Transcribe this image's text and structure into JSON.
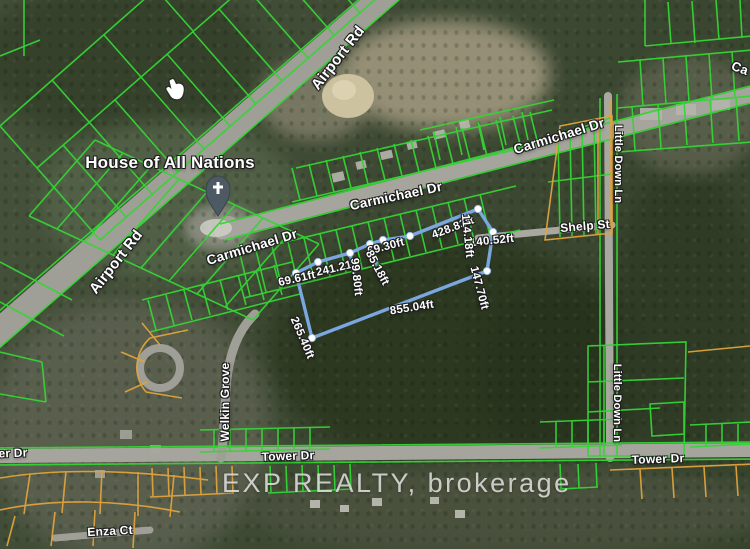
{
  "map": {
    "type": "satellite-parcel-map",
    "watermark": "EXP REALTY, brokerage",
    "poi": {
      "house_of_all_nations": "House of All Nations"
    },
    "roads": {
      "airport_rd_upper": "Airport Rd",
      "airport_rd_lower": "Airport Rd",
      "carmichael_dr_upper": "Carmichael Dr",
      "carmichael_dr_mid": "Carmichael Dr",
      "carmichael_dr_lower": "Carmichael Dr",
      "carmichael_dr_edge_partial": "Ca",
      "little_down_ln_upper": "Little Down Ln",
      "little_down_ln_lower": "Little Down Ln",
      "shelp_st": "Shelp St",
      "welkin_grove": "Welkin Grove",
      "tower_dr_left_partial": "er Dr",
      "tower_dr_mid": "Tower Dr",
      "tower_dr_right": "Tower Dr",
      "enza_ct": "Enza Ct"
    },
    "measurements": {
      "seg1": "69.61ft",
      "seg2": "241.21ft",
      "seg3": "69.30ft",
      "seg4": "99.80ft",
      "seg5": "85.18ft",
      "seg6": "428.83ft",
      "seg7": "114.18ft",
      "seg8": "140.52ft",
      "seg9": "147.70ft",
      "seg10": "855.04ft",
      "seg11": "265.40ft"
    },
    "icons": {
      "church_pin": "church-place-of-worship-pin",
      "cursor": "mouse-cursor"
    },
    "colors": {
      "parcel_green": "#35d435",
      "parcel_orange": "#dfa33c",
      "measure_blue": "#7aa7e0",
      "road_gray": "#a2a29a",
      "label_white": "#ffffff",
      "watermark_gray": "#e8e8e6"
    }
  }
}
